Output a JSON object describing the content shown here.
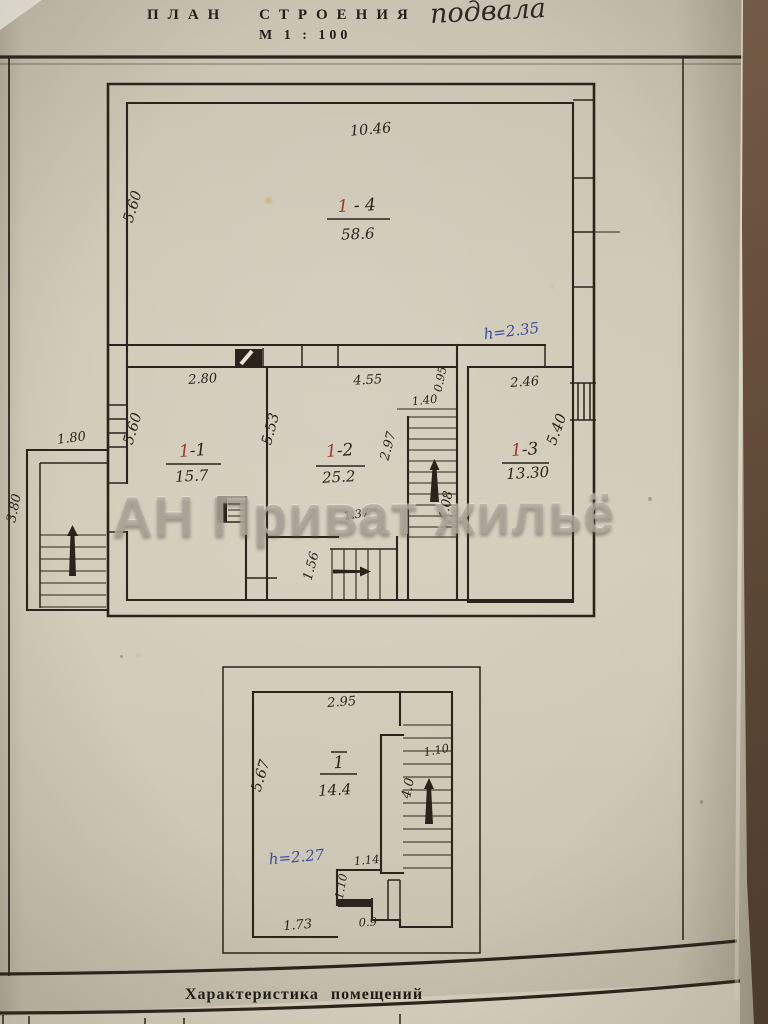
{
  "page": {
    "title_printed": "ПЛАН СТРОЕНИЯ",
    "title_handwritten": "подвала",
    "scale": "М 1 : 100",
    "watermark": "АН Приват жильё",
    "table_caption": "Характеристика помещений"
  },
  "colors": {
    "ink": "#2a251c",
    "red": "#993a2c",
    "blue": "#3b4da0",
    "paper": "#cdc7b5"
  },
  "main_plan": {
    "rooms": [
      {
        "number": "1-4",
        "area_m2": "58.6"
      },
      {
        "number": "1-1",
        "area_m2": "15.7"
      },
      {
        "number": "1-2",
        "area_m2": "25.2"
      },
      {
        "number": "1-3",
        "area_m2": "13.30"
      }
    ],
    "ceiling_height_note": "h=2.35"
  },
  "lower_plan": {
    "rooms": [
      {
        "number": "1",
        "area_m2": "14.4"
      }
    ],
    "ceiling_height_note": "h=2.27"
  },
  "plan_labels": [
    {
      "t": "10.46",
      "x": 371,
      "y": 134,
      "r": -5,
      "cls": "dim-lg",
      "kind": "dimension-label"
    },
    {
      "t": "5.60",
      "x": 137,
      "y": 208,
      "r": -73,
      "cls": "dim-lg",
      "kind": "dimension-label"
    },
    {
      "parts": [
        {
          "t": "1",
          "c": "red"
        },
        {
          "t": " - 4",
          "c": "ink"
        }
      ],
      "x": 357,
      "y": 211,
      "r": -3,
      "cls": "room",
      "kind": "room-number"
    },
    {
      "t": "58.6",
      "x": 358,
      "y": 239,
      "r": -2,
      "cls": "area",
      "kind": "room-area"
    },
    {
      "t": "h=2.35",
      "x": 512,
      "y": 336,
      "r": -7,
      "cls": "blue",
      "kind": "height-note"
    },
    {
      "t": "2.80",
      "x": 203,
      "y": 383,
      "r": -4,
      "cls": "dim",
      "kind": "dimension-label"
    },
    {
      "t": "4.55",
      "x": 368,
      "y": 384,
      "r": -3,
      "cls": "dim",
      "kind": "dimension-label"
    },
    {
      "t": "0.95",
      "x": 444,
      "y": 380,
      "r": -78,
      "cls": "dim-sm",
      "kind": "dimension-label"
    },
    {
      "t": "2.46",
      "x": 525,
      "y": 386,
      "r": -4,
      "cls": "dim",
      "kind": "dimension-label"
    },
    {
      "t": "1.40",
      "x": 425,
      "y": 404,
      "r": -6,
      "cls": "dim-sm",
      "kind": "dimension-label"
    },
    {
      "t": "5.60",
      "x": 137,
      "y": 430,
      "r": -73,
      "cls": "dim-lg",
      "kind": "dimension-label"
    },
    {
      "t": "5.53",
      "x": 275,
      "y": 430,
      "r": -75,
      "cls": "dim-lg",
      "kind": "dimension-label"
    },
    {
      "parts": [
        {
          "t": "1",
          "c": "red"
        },
        {
          "t": "-1",
          "c": "ink"
        }
      ],
      "x": 193,
      "y": 456,
      "r": -4,
      "cls": "room",
      "kind": "room-number"
    },
    {
      "t": "15.7",
      "x": 192,
      "y": 481,
      "r": -3,
      "cls": "area",
      "kind": "room-area"
    },
    {
      "parts": [
        {
          "t": "1",
          "c": "red"
        },
        {
          "t": "-2",
          "c": "ink"
        }
      ],
      "x": 340,
      "y": 456,
      "r": -4,
      "cls": "room",
      "kind": "room-number"
    },
    {
      "t": "25.2",
      "x": 339,
      "y": 482,
      "r": -3,
      "cls": "area",
      "kind": "room-area"
    },
    {
      "t": "2.97",
      "x": 392,
      "y": 447,
      "r": -75,
      "cls": "dim",
      "kind": "dimension-label"
    },
    {
      "t": "4.08",
      "x": 450,
      "y": 506,
      "r": -80,
      "cls": "dim",
      "kind": "dimension-label"
    },
    {
      "parts": [
        {
          "t": "1",
          "c": "red"
        },
        {
          "t": "-3",
          "c": "ink"
        }
      ],
      "x": 525,
      "y": 455,
      "r": -4,
      "cls": "room",
      "kind": "room-number"
    },
    {
      "t": "13.30",
      "x": 528,
      "y": 478,
      "r": -3,
      "cls": "area",
      "kind": "room-area"
    },
    {
      "t": "5.40",
      "x": 561,
      "y": 431,
      "r": -70,
      "cls": "dim-lg",
      "kind": "dimension-label"
    },
    {
      "t": "1.80",
      "x": 72,
      "y": 442,
      "r": -7,
      "cls": "dim",
      "kind": "dimension-label"
    },
    {
      "t": "3.80",
      "x": 18,
      "y": 509,
      "r": -78,
      "cls": "dim",
      "kind": "dimension-label"
    },
    {
      "t": "1.56",
      "x": 315,
      "y": 567,
      "r": -75,
      "cls": "dim",
      "kind": "dimension-label"
    },
    {
      "t": "1.37",
      "x": 357,
      "y": 518,
      "r": -8,
      "cls": "dim-sm",
      "kind": "dimension-label"
    },
    {
      "t": "2.95",
      "x": 342,
      "y": 706,
      "r": -4,
      "cls": "dim",
      "kind": "dimension-label"
    },
    {
      "t": "5.67",
      "x": 265,
      "y": 777,
      "r": -73,
      "cls": "dim-lg",
      "kind": "dimension-label"
    },
    {
      "t": "1",
      "x": 339,
      "y": 768,
      "r": -3,
      "cls": "room",
      "kind": "room-number"
    },
    {
      "t": "14.4",
      "x": 335,
      "y": 795,
      "r": -3,
      "cls": "area",
      "kind": "room-area"
    },
    {
      "t": "h=2.27",
      "x": 297,
      "y": 862,
      "r": -5,
      "cls": "blue",
      "kind": "height-note"
    },
    {
      "t": "1.10",
      "x": 437,
      "y": 754,
      "r": -10,
      "cls": "dim-sm",
      "kind": "dimension-label"
    },
    {
      "t": "4.0",
      "x": 412,
      "y": 789,
      "r": -78,
      "cls": "dim",
      "kind": "dimension-label"
    },
    {
      "t": "1.14",
      "x": 367,
      "y": 864,
      "r": -5,
      "cls": "dim-sm",
      "kind": "dimension-label"
    },
    {
      "t": "1.10",
      "x": 345,
      "y": 887,
      "r": -80,
      "cls": "dim-sm",
      "kind": "dimension-label"
    },
    {
      "t": "0.9",
      "x": 368,
      "y": 926,
      "r": -3,
      "cls": "dim-sm",
      "kind": "dimension-label"
    },
    {
      "t": "1.73",
      "x": 298,
      "y": 929,
      "r": -5,
      "cls": "dim",
      "kind": "dimension-label"
    }
  ]
}
